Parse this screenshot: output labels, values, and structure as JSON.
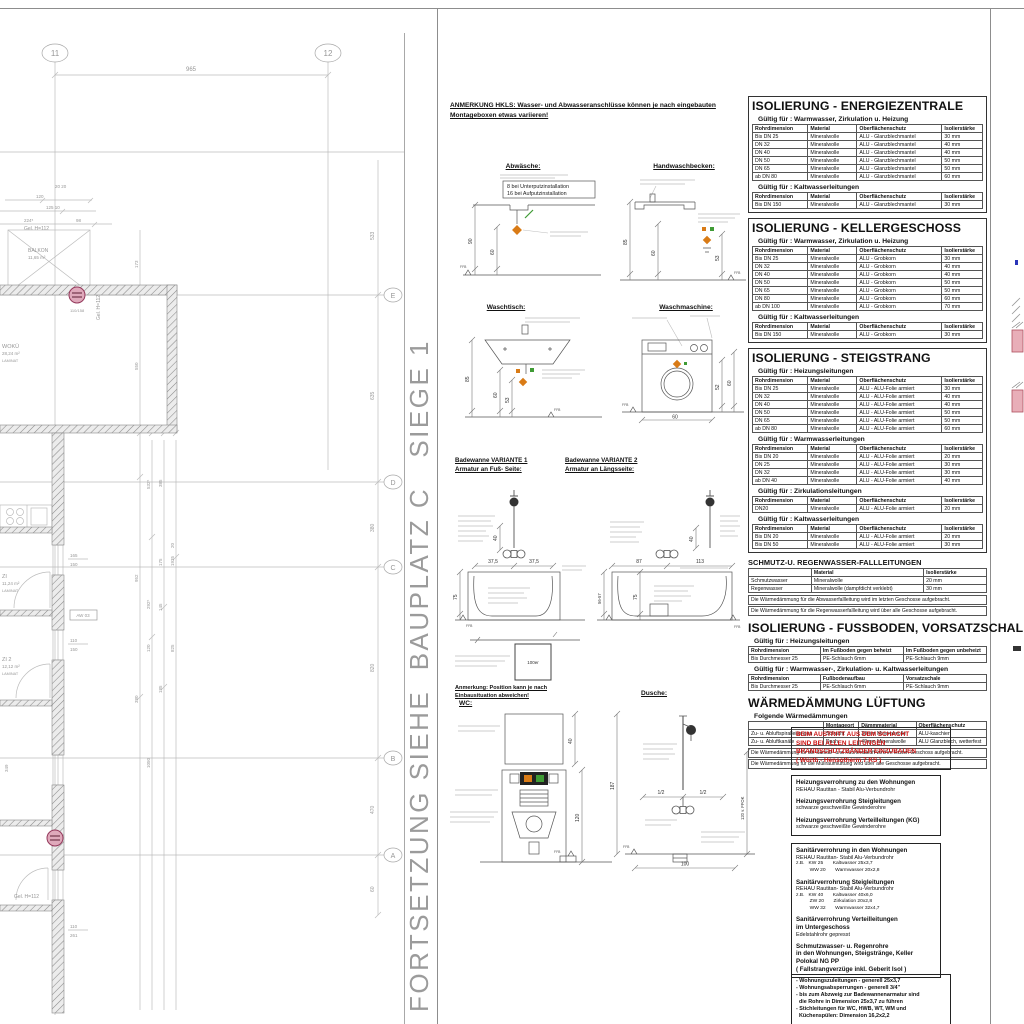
{
  "divider_text": "FORTSETZUNG SIEHE  BAUPLATZ C   SIEGE 1",
  "plan": {
    "grid_top": [
      "11",
      "12"
    ],
    "grid_right": [
      "E",
      "D",
      "C",
      "B",
      "A"
    ],
    "dims": {
      "top": "965",
      "r1": "533",
      "r2": "635",
      "r3": "380",
      "r4": "820",
      "r5": "470",
      "r6": "60",
      "c1": "173",
      "c2": "550",
      "c3": "952",
      "c4": "380",
      "c5": "532⁵",
      "c6": "292⁵",
      "c7": "120",
      "c8": "1050",
      "c9": "385",
      "c10": "175",
      "c11": "145",
      "c12": "185",
      "c13": "1935",
      "c14": "20",
      "c15": "825",
      "t1": "120",
      "t2": "125 10",
      "t3": "224⁵",
      "t4": "98",
      "t5": "20  20",
      "w1": "165",
      "w2": "150",
      "w3": "110",
      "w4": "150",
      "b1": "110",
      "b2": "261",
      "b3": "349"
    },
    "labels": {
      "balkon": "BALKON",
      "balkon_area": "11,65 m²",
      "woku": "WOKÜ",
      "woku_area": "28,24 m²",
      "laminat": "LAMINAT",
      "zi1": "ZI",
      "zi1_area": "11,24 m²",
      "zi2": "ZI 2",
      "zi2_area": "12,12 m²",
      "gel": "Gel. H=112",
      "gel2": "Gel. H=112",
      "aw": "AW 03",
      "riser": "110/158"
    }
  },
  "anmerkung": {
    "header_line1": "ANMERKUNG HKLS: Wasser- und Abwasseranschlüsse können je nach eingebauten",
    "header_line2": "Montageboxen etwas variieren!",
    "position_line1": "Anmerkung: Position kann je nach",
    "position_line2": "Einbausituation abweichen!"
  },
  "fixtures": {
    "abwaesche": {
      "label": "Abwäsche:",
      "note1": "8 bei  Unterputzinstallation",
      "note2": "16 bei  Aufputzinstallation",
      "dim1": "90",
      "dim2": "60",
      "ffb": "FFB"
    },
    "handwaschbecken": {
      "label": "Handwaschbecken:",
      "dim1": "85",
      "dim2": "60",
      "dim3": "53",
      "ffb": "FFB"
    },
    "waschtisch": {
      "label": "Waschtisch:",
      "dim1": "85",
      "dim2": "60",
      "dim3": "53",
      "ffb": "FFB"
    },
    "waschmaschine": {
      "label": "Waschmaschine:",
      "dim1": "52",
      "dim2": "60",
      "dim3": "60",
      "ffb": "FFB"
    },
    "badewanne1": {
      "label": "Badewanne VARIANTE 1",
      "sublabel": "Armatur an Fuß- Seite:",
      "dim1": "37,5",
      "dim2": "37,5",
      "dim3": "40",
      "dim4": "75",
      "ffb": "FFB"
    },
    "badewanne2": {
      "label": "Badewanne VARIANTE 2",
      "sublabel": "Armatur an Längsseite:",
      "dim1": "87",
      "dim2": "113",
      "dim3": "40",
      "dim4": "75",
      "dim5": "56-57",
      "ffb": "FFB"
    },
    "box100": {
      "label": "100er"
    },
    "wc": {
      "label": "WC:",
      "dim1": "40",
      "dim2": "120",
      "ffb": "FFB"
    },
    "dusche": {
      "label": "Dusche:",
      "dim1": "187",
      "dim2": "120 v. FFOK",
      "dim3": "100",
      "half1": "1/2",
      "half2": "1/2",
      "ffb": "FFB"
    }
  },
  "tables": [
    {
      "title": "ISOLIERUNG - ENERGIEZENTRALE",
      "sections": [
        {
          "subtitle": "Gültig für : Warmwasser, Zirkulation u. Heizung",
          "headers": [
            "Rohrdimension",
            "Material",
            "Oberflächenschutz",
            "Isolierstärke"
          ],
          "rows": [
            [
              "Bis DN 25",
              "Mineralwolle",
              "ALU - Glanzblechmantel",
              "30 mm"
            ],
            [
              "DN 32",
              "Mineralwolle",
              "ALU - Glanzblechmantel",
              "40 mm"
            ],
            [
              "DN 40",
              "Mineralwolle",
              "ALU - Glanzblechmantel",
              "40 mm"
            ],
            [
              "DN 50",
              "Mineralwolle",
              "ALU - Glanzblechmantel",
              "50 mm"
            ],
            [
              "DN 65",
              "Mineralwolle",
              "ALU - Glanzblechmantel",
              "50 mm"
            ],
            [
              "ab DN 80",
              "Mineralwolle",
              "ALU - Glanzblechmantel",
              "60 mm"
            ]
          ]
        },
        {
          "subtitle": "Gültig für : Kaltwasserleitungen",
          "headers": [
            "Rohrdimension",
            "Material",
            "Oberflächenschutz",
            "Isolierstärke"
          ],
          "rows": [
            [
              "Bis DN 150",
              "Mineralwolle",
              "ALU - Glanzblechmantel",
              "30 mm"
            ]
          ]
        }
      ],
      "notes": []
    },
    {
      "title": "ISOLIERUNG - KELLERGESCHOSS",
      "sections": [
        {
          "subtitle": "Gültig für : Warmwasser, Zirkulation u. Heizung",
          "headers": [
            "Rohrdimension",
            "Material",
            "Oberflächenschutz",
            "Isolierstärke"
          ],
          "rows": [
            [
              "Bis DN 25",
              "Mineralwolle",
              "ALU - Grobkorn",
              "30 mm"
            ],
            [
              "DN 32",
              "Mineralwolle",
              "ALU - Grobkorn",
              "40 mm"
            ],
            [
              "DN 40",
              "Mineralwolle",
              "ALU - Grobkorn",
              "40 mm"
            ],
            [
              "DN 50",
              "Mineralwolle",
              "ALU - Grobkorn",
              "50 mm"
            ],
            [
              "DN 65",
              "Mineralwolle",
              "ALU - Grobkorn",
              "50 mm"
            ],
            [
              "DN 80",
              "Mineralwolle",
              "ALU - Grobkorn",
              "60 mm"
            ],
            [
              "ab DN 100",
              "Mineralwolle",
              "ALU - Grobkorn",
              "70 mm"
            ]
          ]
        },
        {
          "subtitle": "Gültig für : Kaltwasserleitungen",
          "headers": [
            "Rohrdimension",
            "Material",
            "Oberflächenschutz",
            "Isolierstärke"
          ],
          "rows": [
            [
              "Bis DN 150",
              "Mineralwolle",
              "ALU - Grobkorn",
              "30 mm"
            ]
          ]
        }
      ],
      "notes": []
    },
    {
      "title": "ISOLIERUNG - STEIGSTRANG",
      "sections": [
        {
          "subtitle": "Gültig für : Heizungsleitungen",
          "headers": [
            "Rohrdimension",
            "Material",
            "Oberflächenschutz",
            "Isolierstärke"
          ],
          "rows": [
            [
              "Bis DN 25",
              "Mineralwolle",
              "ALU - ALU-Folie armiert",
              "30 mm"
            ],
            [
              "DN 32",
              "Mineralwolle",
              "ALU - ALU-Folie armiert",
              "40 mm"
            ],
            [
              "DN 40",
              "Mineralwolle",
              "ALU - ALU-Folie armiert",
              "40 mm"
            ],
            [
              "DN 50",
              "Mineralwolle",
              "ALU - ALU-Folie armiert",
              "50 mm"
            ],
            [
              "DN 65",
              "Mineralwolle",
              "ALU - ALU-Folie armiert",
              "50 mm"
            ],
            [
              "ab DN 80",
              "Mineralwolle",
              "ALU - ALU-Folie armiert",
              "60 mm"
            ]
          ]
        },
        {
          "subtitle": "Gültig für : Warmwasserleitungen",
          "headers": [
            "Rohrdimension",
            "Material",
            "Oberflächenschutz",
            "Isolierstärke"
          ],
          "rows": [
            [
              "Bis DN 20",
              "Mineralwolle",
              "ALU - ALU-Folie armiert",
              "20 mm"
            ],
            [
              "DN 25",
              "Mineralwolle",
              "ALU - ALU-Folie armiert",
              "30 mm"
            ],
            [
              "DN 32",
              "Mineralwolle",
              "ALU - ALU-Folie armiert",
              "30 mm"
            ],
            [
              "ab DN 40",
              "Mineralwolle",
              "ALU - ALU-Folie armiert",
              "40 mm"
            ]
          ]
        },
        {
          "subtitle": "Gültig für : Zirkulationsleitungen",
          "headers": [
            "Rohrdimension",
            "Material",
            "Oberflächenschutz",
            "Isolierstärke"
          ],
          "rows": [
            [
              "DN20",
              "Mineralwolle",
              "ALU - ALU-Folie armiert",
              "20 mm"
            ]
          ]
        },
        {
          "subtitle": "Gültig für : Kaltwasserleitungen",
          "headers": [
            "Rohrdimension",
            "Material",
            "Oberflächenschutz",
            "Isolierstärke"
          ],
          "rows": [
            [
              "Bis DN 20",
              "Mineralwolle",
              "ALU - ALU-Folie armiert",
              "20 mm"
            ],
            [
              "Bis DN 50",
              "Mineralwolle",
              "ALU - ALU-Folie armiert",
              "30 mm"
            ]
          ]
        }
      ],
      "notes": []
    },
    {
      "title": "SCHMUTZ-U. REGENWASSER-FALLLEITUNGEN",
      "sections": [
        {
          "subtitle": "",
          "headers": [
            "",
            "Material",
            "Isolierstärke"
          ],
          "rows": [
            [
              "Schmutzwasser",
              "Mineralwolle",
              "20 mm"
            ],
            [
              "Regenwasser",
              "Mineralwolle (dampfdicht verklebt)",
              "30 mm"
            ]
          ]
        }
      ],
      "notes": [
        "Die Wärmedämmung für die Abwasserfallleitung wird im letzten Geschosse aufgebracht.",
        "Die Wärmedämmung für die Regenwasserfallleitung wird über alle Geschosse aufgebracht."
      ]
    },
    {
      "title": "ISOLIERUNG - FUSSBODEN,  VORSATZSCHALE",
      "sections": [
        {
          "subtitle": "Gültig für : Heizungsleitungen",
          "headers": [
            "Rohrdimension",
            "Im Fußboden gegen beheizt",
            "Im Fußboden gegen unbeheizt"
          ],
          "rows": [
            [
              "Bis Durchmesser 25",
              "PE-Schlauch 6mm",
              "PE-Schlauch 9mm"
            ]
          ]
        },
        {
          "subtitle": "Gültig für : Warmwasser-, Zirkulation- u. Kaltwasserleitungen",
          "headers": [
            "Rohrdimension",
            "Fußbodenaufbau",
            "Vorsatzschale"
          ],
          "rows": [
            [
              "Bis Durchmesser 25",
              "PE-Schlauch 6mm",
              "PE-Schlauch 9mm"
            ]
          ]
        }
      ],
      "notes": []
    },
    {
      "title": "WÄRMEDÄMMUNG LÜFTUNG",
      "sections": [
        {
          "subtitle": "Folgende Wärmedämmungen",
          "headers": [
            "",
            "Montageort",
            "Dämmmaterial",
            "Oberflächenschutz"
          ],
          "rows": [
            [
              "Zu- u. Abluftspiralleitungen",
              "Schacht",
              "30mm Mineralwolle",
              "ALU-kaschiert"
            ],
            [
              "Zu- u. Abluftkanäle",
              "Dach",
              "40mm Mineralwolle",
              "ALU Glanzblech, wetterfest"
            ]
          ]
        }
      ],
      "notes": [
        "Die Wärmedämmung für die Sanitär- und Küchenabluft wird im letzten Geschoss aufgebracht.",
        "Die Wärmedämmung für die Müllraumlüftung wird über alle Geschosse aufgebracht."
      ]
    }
  ],
  "warning_box": {
    "lines": [
      "BEIM AUSTRITT AUS DEM SCHACHT",
      "SIND BEI ALLEN LEITUNGEN",
      "BRANDSCHUTZBÄNDER EINZUBAUEN",
      "( Würth - Hensotherm 7 KS )"
    ]
  },
  "spec_boxes": [
    {
      "lines": [
        {
          "t": "Heizungsverrohrung zu den Wohnungen",
          "s": "b"
        },
        {
          "t": "REHAU Rautitan - Stabil Alu-Verbundrohr",
          "s": "n"
        },
        {
          "t": "Heizungsverrohrung Steigleitungen",
          "s": "bt"
        },
        {
          "t": "schwarze geschweißte Gewinderohre",
          "s": "n"
        },
        {
          "t": "Heizungsverrohrung Verteilleitungen (KG)",
          "s": "bt"
        },
        {
          "t": "schwarze geschweißte Gewinderohre",
          "s": "n"
        }
      ]
    },
    {
      "lines": [
        {
          "t": "Sanitärverrohrung in den Wohnungen",
          "s": "b"
        },
        {
          "t": "REHAU Rautitan- Stabil Alu-Verbundrohr",
          "s": "n"
        },
        {
          "t": "z.B.   KW 25       Kaltwasser 25x3,7",
          "s": "i"
        },
        {
          "t": "          WW 20       Warmwasser 20x2,8",
          "s": "i"
        },
        {
          "t": "Sanitärverrohrung Steigleitungen",
          "s": "bt"
        },
        {
          "t": "REHAU Rautitan- Stabil Alu-Verbundrohr",
          "s": "n"
        },
        {
          "t": "z.B.   KW 40       Kaltwasser 40x6,0",
          "s": "i"
        },
        {
          "t": "          ZW 20       Zirkulation 20x2,8",
          "s": "i"
        },
        {
          "t": "          WW 32       Warmwasser 32x4,7",
          "s": "i"
        },
        {
          "t": "Sanitärverrohrung Verteilleitungen",
          "s": "bt"
        },
        {
          "t": "im Untergeschoss",
          "s": "b"
        },
        {
          "t": "Edelstahlrohr gepresst",
          "s": "n"
        },
        {
          "t": "Schmutzwasser- u. Regenrohre",
          "s": "bt"
        },
        {
          "t": "in den Wohnungen, Steigstränge, Keller",
          "s": "b"
        },
        {
          "t": "Polokal NG PP",
          "s": "b"
        },
        {
          "t": "( Fallstrangverzüge inkl. Geberit Isol )",
          "s": "b"
        }
      ]
    }
  ],
  "bullets_box": {
    "lines": [
      "- Wohnungszuleitungen - generell 25x3,7",
      "- Wohnungsabsperrungen - generell 3/4\"",
      "- bis zum Abzweig zur Badewannenarmatur sind",
      "  die Rohre in Dimension 25x3,7 zu führen",
      "- Stichleitungen für WC, HWB, WT, WM und",
      "  Küchenspülen: Dimension 16,2x2,2"
    ]
  }
}
